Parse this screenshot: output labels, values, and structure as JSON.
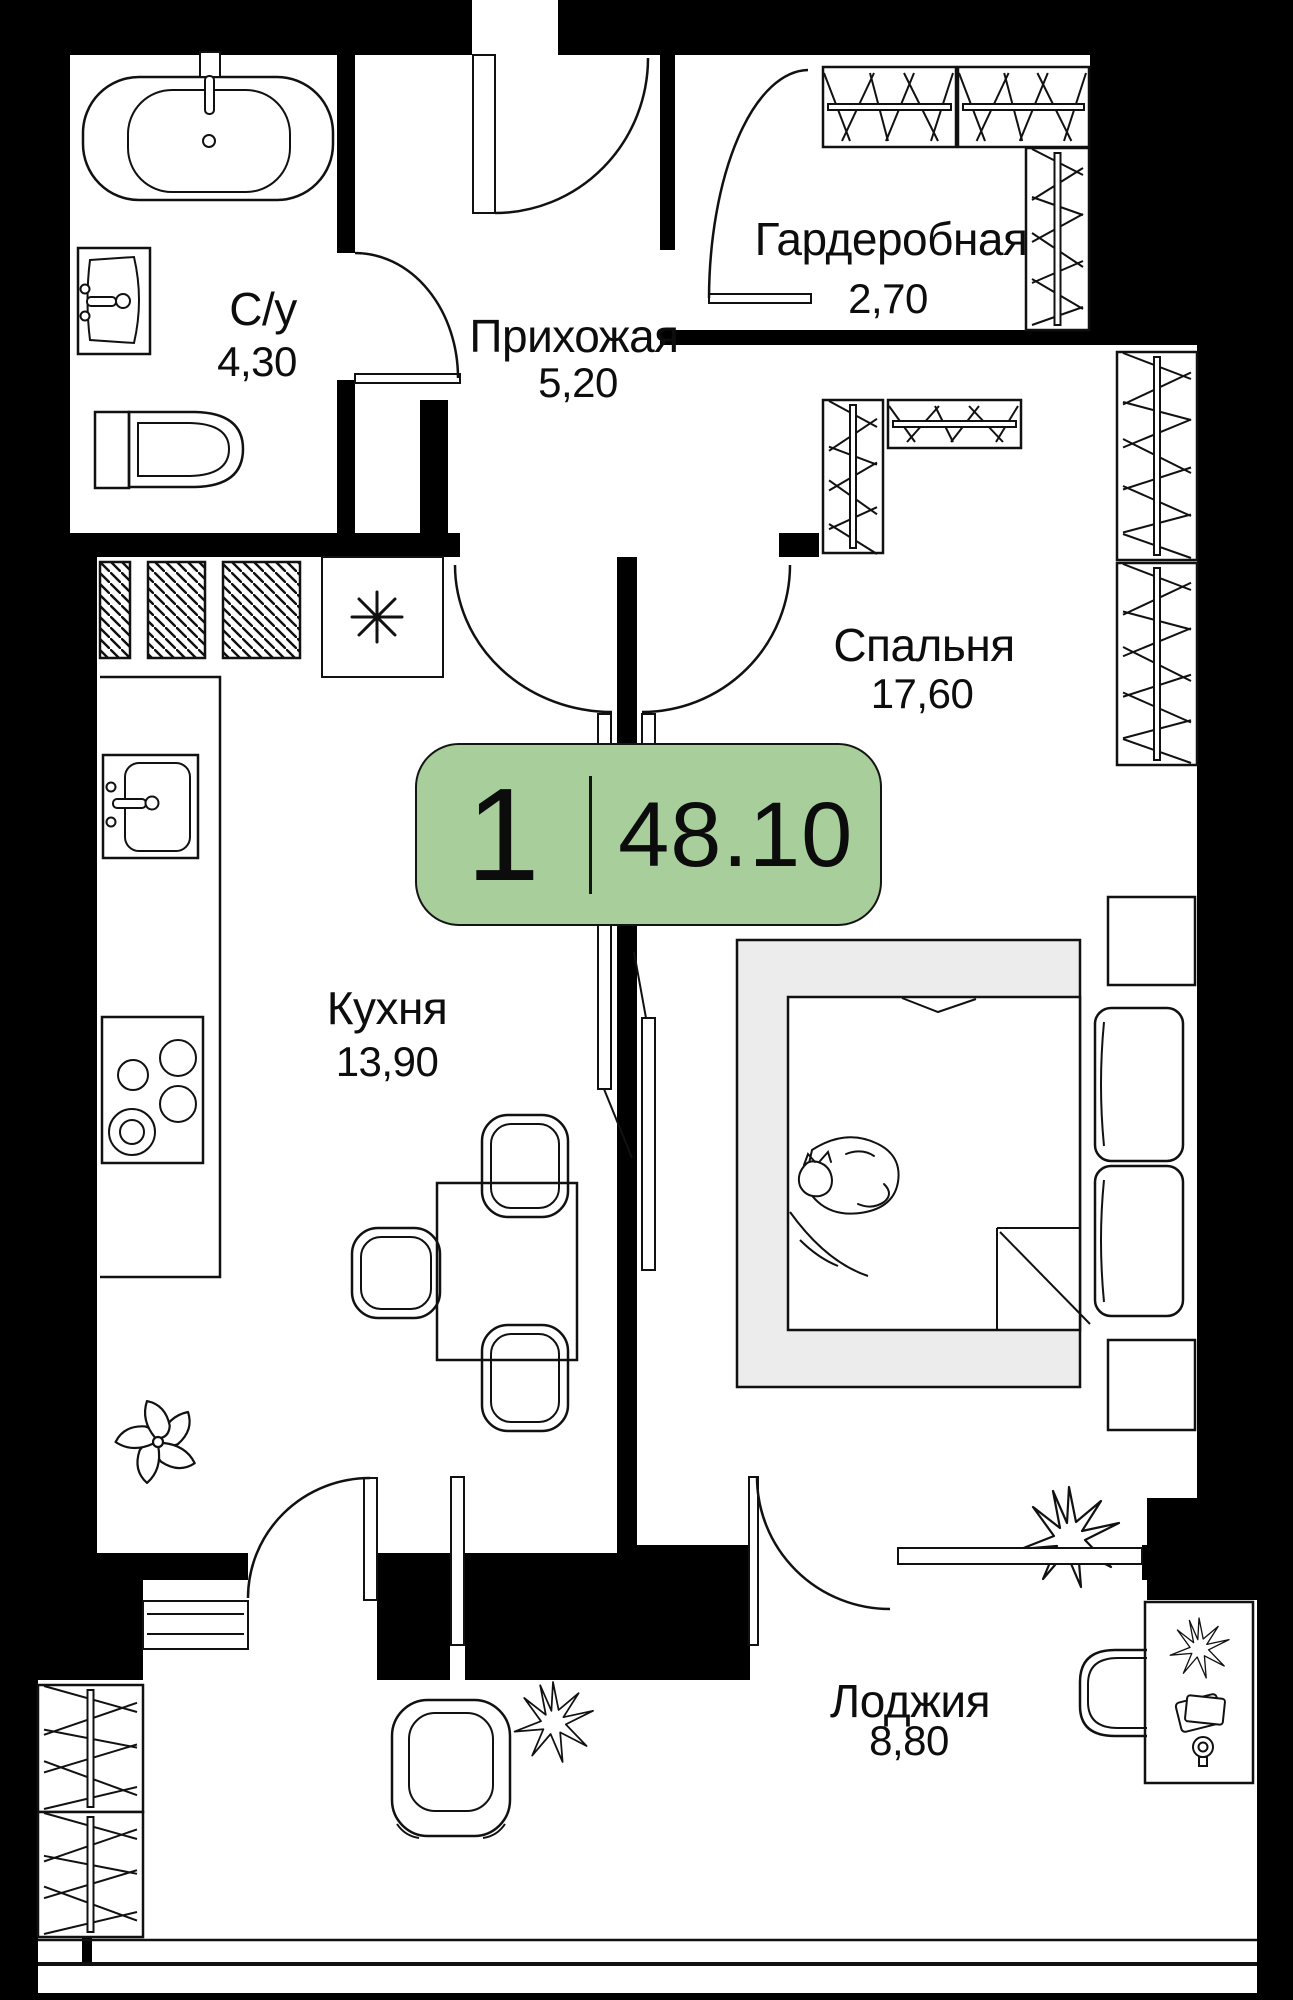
{
  "plan": {
    "badge": {
      "rooms_count": "1",
      "total_area": "48.10"
    },
    "rooms": [
      {
        "name": "С/у",
        "area": "4,30"
      },
      {
        "name": "Прихожая",
        "area": "5,20"
      },
      {
        "name": "Гардеробная",
        "area": "2,70"
      },
      {
        "name": "Спальня",
        "area": "17,60"
      },
      {
        "name": "Кухня",
        "area": "13,90"
      },
      {
        "name": "Лоджия",
        "area": "8,80"
      }
    ],
    "colors": {
      "badge_green": "#a8cf9b",
      "wall_black": "#000000",
      "bed_gray": "#ececec",
      "line": "#111111"
    },
    "furniture": [
      "bathtub",
      "bath-sink",
      "toilet",
      "kitchen-sink",
      "stove",
      "dining-table",
      "chairs",
      "fridge-asterisk",
      "wardrobe-units",
      "bed",
      "cat",
      "pillows",
      "nightstands",
      "armchair",
      "desk",
      "desk-chair",
      "plants"
    ]
  }
}
